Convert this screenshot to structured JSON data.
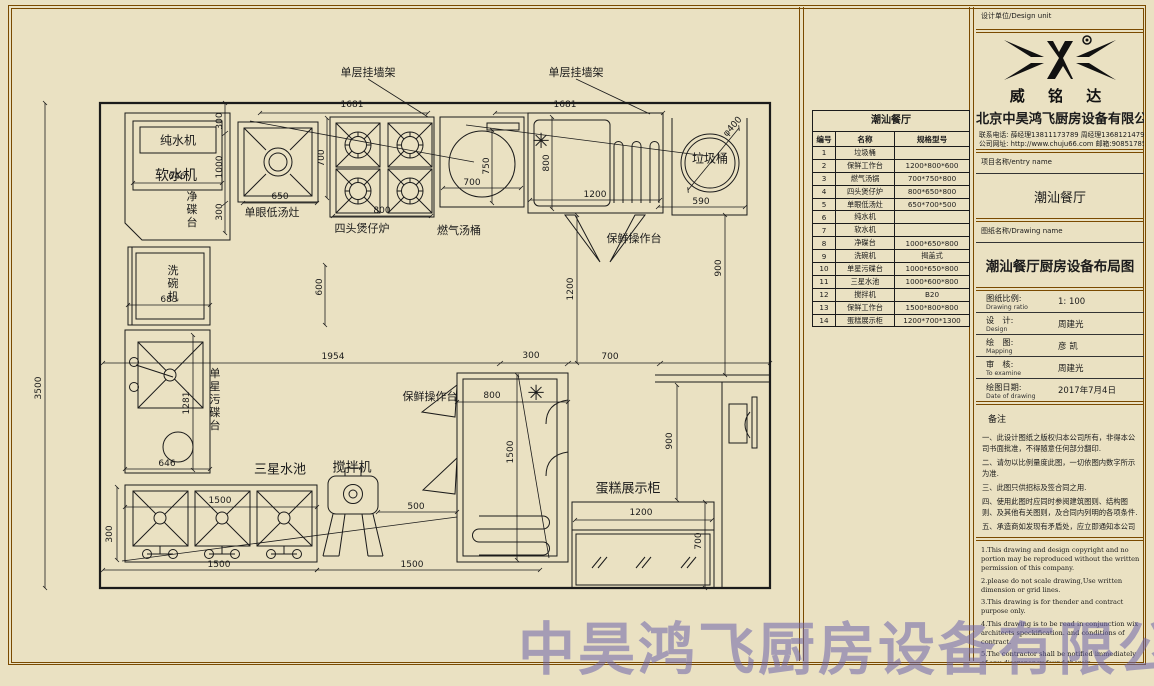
{
  "watermark": "中昊鸿飞厨房设备有限公司",
  "plan": {
    "labels": [
      {
        "text": "单层挂墙架",
        "x": 368,
        "y": 72
      },
      {
        "text": "单层挂墙架",
        "x": 576,
        "y": 72
      },
      {
        "text": "纯水机",
        "x": 178,
        "y": 140,
        "size": 12
      },
      {
        "text": "软水机",
        "x": 176,
        "y": 175,
        "size": 14
      },
      {
        "text": "净碟台",
        "x": 191,
        "y": 210,
        "vert": 1
      },
      {
        "text": "单眼低汤灶",
        "x": 272,
        "y": 212
      },
      {
        "text": "四头煲仔炉",
        "x": 362,
        "y": 228
      },
      {
        "text": "燃气汤桶",
        "x": 459,
        "y": 230
      },
      {
        "text": "保鲜操作台",
        "x": 634,
        "y": 238
      },
      {
        "text": "垃圾桶",
        "x": 710,
        "y": 158,
        "size": 12
      },
      {
        "text": "洗碗机",
        "x": 172,
        "y": 284,
        "vert": 1
      },
      {
        "text": "单星污碟台",
        "x": 214,
        "y": 400,
        "vert": 1
      },
      {
        "text": "三星水池",
        "x": 280,
        "y": 468,
        "size": 13
      },
      {
        "text": "搅拌机",
        "x": 352,
        "y": 466,
        "size": 13
      },
      {
        "text": "保鲜操作台",
        "x": 430,
        "y": 396
      },
      {
        "text": "蛋糕展示柜",
        "x": 628,
        "y": 487,
        "size": 13
      }
    ],
    "dims": [
      {
        "t": "1681",
        "x": 352,
        "y": 105
      },
      {
        "t": "1681",
        "x": 565,
        "y": 105
      },
      {
        "t": "300",
        "x": 220,
        "y": 121,
        "rot": 1
      },
      {
        "t": "1000",
        "x": 220,
        "y": 167,
        "rot": 1
      },
      {
        "t": "300",
        "x": 220,
        "y": 212,
        "rot": 1
      },
      {
        "t": "650",
        "x": 280,
        "y": 197
      },
      {
        "t": "700",
        "x": 322,
        "y": 158,
        "rot": 1
      },
      {
        "t": "800",
        "x": 382,
        "y": 211
      },
      {
        "t": "700",
        "x": 472,
        "y": 183
      },
      {
        "t": "750",
        "x": 487,
        "y": 166,
        "rot": 1
      },
      {
        "t": "800",
        "x": 547,
        "y": 163,
        "rot": 1
      },
      {
        "t": "1200",
        "x": 595,
        "y": 195
      },
      {
        "t": "590",
        "x": 701,
        "y": 202
      },
      {
        "t": "900",
        "x": 719,
        "y": 268,
        "rot": 1
      },
      {
        "t": "1200",
        "x": 571,
        "y": 289,
        "rot": 1
      },
      {
        "t": "646",
        "x": 177,
        "y": 177
      },
      {
        "t": "683",
        "x": 169,
        "y": 300
      },
      {
        "t": "600",
        "x": 320,
        "y": 287,
        "rot": 1
      },
      {
        "t": "3500",
        "x": 39,
        "y": 388,
        "rot": 1
      },
      {
        "t": "1281",
        "x": 187,
        "y": 403,
        "rot": 1
      },
      {
        "t": "646",
        "x": 167,
        "y": 464
      },
      {
        "t": "1954",
        "x": 333,
        "y": 357
      },
      {
        "t": "300",
        "x": 531,
        "y": 356
      },
      {
        "t": "700",
        "x": 610,
        "y": 357
      },
      {
        "t": "800",
        "x": 492,
        "y": 396
      },
      {
        "t": "1500",
        "x": 511,
        "y": 452,
        "rot": 1
      },
      {
        "t": "500",
        "x": 416,
        "y": 507
      },
      {
        "t": "1500",
        "x": 220,
        "y": 501
      },
      {
        "t": "300",
        "x": 110,
        "y": 534,
        "rot": 1
      },
      {
        "t": "1500",
        "x": 219,
        "y": 565
      },
      {
        "t": "1500",
        "x": 412,
        "y": 565
      },
      {
        "t": "900",
        "x": 670,
        "y": 441,
        "rot": 1
      },
      {
        "t": "1200",
        "x": 641,
        "y": 513
      },
      {
        "t": "700",
        "x": 699,
        "y": 541,
        "rot": 1
      },
      {
        "t": "φ400",
        "x": 733,
        "y": 127,
        "rot": 2
      }
    ],
    "symbols": [
      {
        "t": "✳",
        "x": 541,
        "y": 141
      },
      {
        "t": "✳",
        "x": 536,
        "y": 393
      }
    ]
  },
  "equipment_table": {
    "title": "潮汕餐厅",
    "columns": [
      "编号",
      "名称",
      "规格型号"
    ],
    "rows": [
      [
        "1",
        "垃圾桶",
        ""
      ],
      [
        "2",
        "保鲜工作台",
        "1200*800*600"
      ],
      [
        "3",
        "燃气汤锅",
        "700*750*800"
      ],
      [
        "4",
        "四头煲仔炉",
        "800*650*800"
      ],
      [
        "5",
        "单眼低汤灶",
        "650*700*500"
      ],
      [
        "6",
        "纯水机",
        ""
      ],
      [
        "7",
        "软水机",
        ""
      ],
      [
        "8",
        "净碟台",
        "1000*650*800"
      ],
      [
        "9",
        "洗碗机",
        "揭盖式"
      ],
      [
        "10",
        "单星污碟台",
        "1000*650*800"
      ],
      [
        "11",
        "三星水池",
        "1000*600*800"
      ],
      [
        "12",
        "搅拌机",
        "B20"
      ],
      [
        "13",
        "保鲜工作台",
        "1500*800*800"
      ],
      [
        "14",
        "蛋糕展示柜",
        "1200*700*1300"
      ]
    ]
  },
  "title_block": {
    "design_unit_label": "设计单位/Design unit",
    "logo_text": "威 铭 达",
    "company": "北京中昊鸿飞厨房设备有限公司",
    "contact_line1": "联系电话: 薛经理13811173789    周经理13681214796",
    "contact_line2": "公司网址: http://www.chuju66.com  邮箱:908517858@qq.com",
    "project_label": "项目名称/entry name",
    "project_name": "潮汕餐厅",
    "drawing_label": "图纸名称/Drawing name",
    "drawing_name": "潮汕餐厅厨房设备布局图",
    "info_rows": [
      {
        "zh": "图纸比例:",
        "en": "Drawing ratio",
        "value": "1: 100"
      },
      {
        "zh": "设　计:",
        "en": "Design",
        "value": "周建光"
      },
      {
        "zh": "绘　图:",
        "en": "Mapping",
        "value": "彦 凯"
      },
      {
        "zh": "审　核:",
        "en": "To examine",
        "value": "周建光"
      },
      {
        "zh": "绘图日期:",
        "en": "Date of drawing",
        "value": "2017年7月4日"
      }
    ],
    "remark_label": "备注",
    "notes_cn": [
      "一、此设计图纸之版权归本公司所有，非得本公司书面批准，不得随意任何部分翻印.",
      "二、请勿以比例量度此图，一切依图内数字所示为准.",
      "三、此图只供招标及签合同之用.",
      "四、使用此图时应同时参阅建筑图则、结构图则、及其他有关图则，及合同内列明的各项条件.",
      "五、承造商如发现有矛盾处，应立即通知本公司"
    ],
    "notes_en": [
      "1.This drawing and design copyright and no portion may be reproduced without the written permission of this company.",
      "2.please do not scale drawing,Use written dimension or grid lines.",
      "3.This drawing is for thender and contract purpose only.",
      "4.This drawing is to be read in conjunction wix architects speckification.  and conditions of contract.",
      "5.The contractor shall be notified immediately of any discrepancy found therein."
    ]
  }
}
